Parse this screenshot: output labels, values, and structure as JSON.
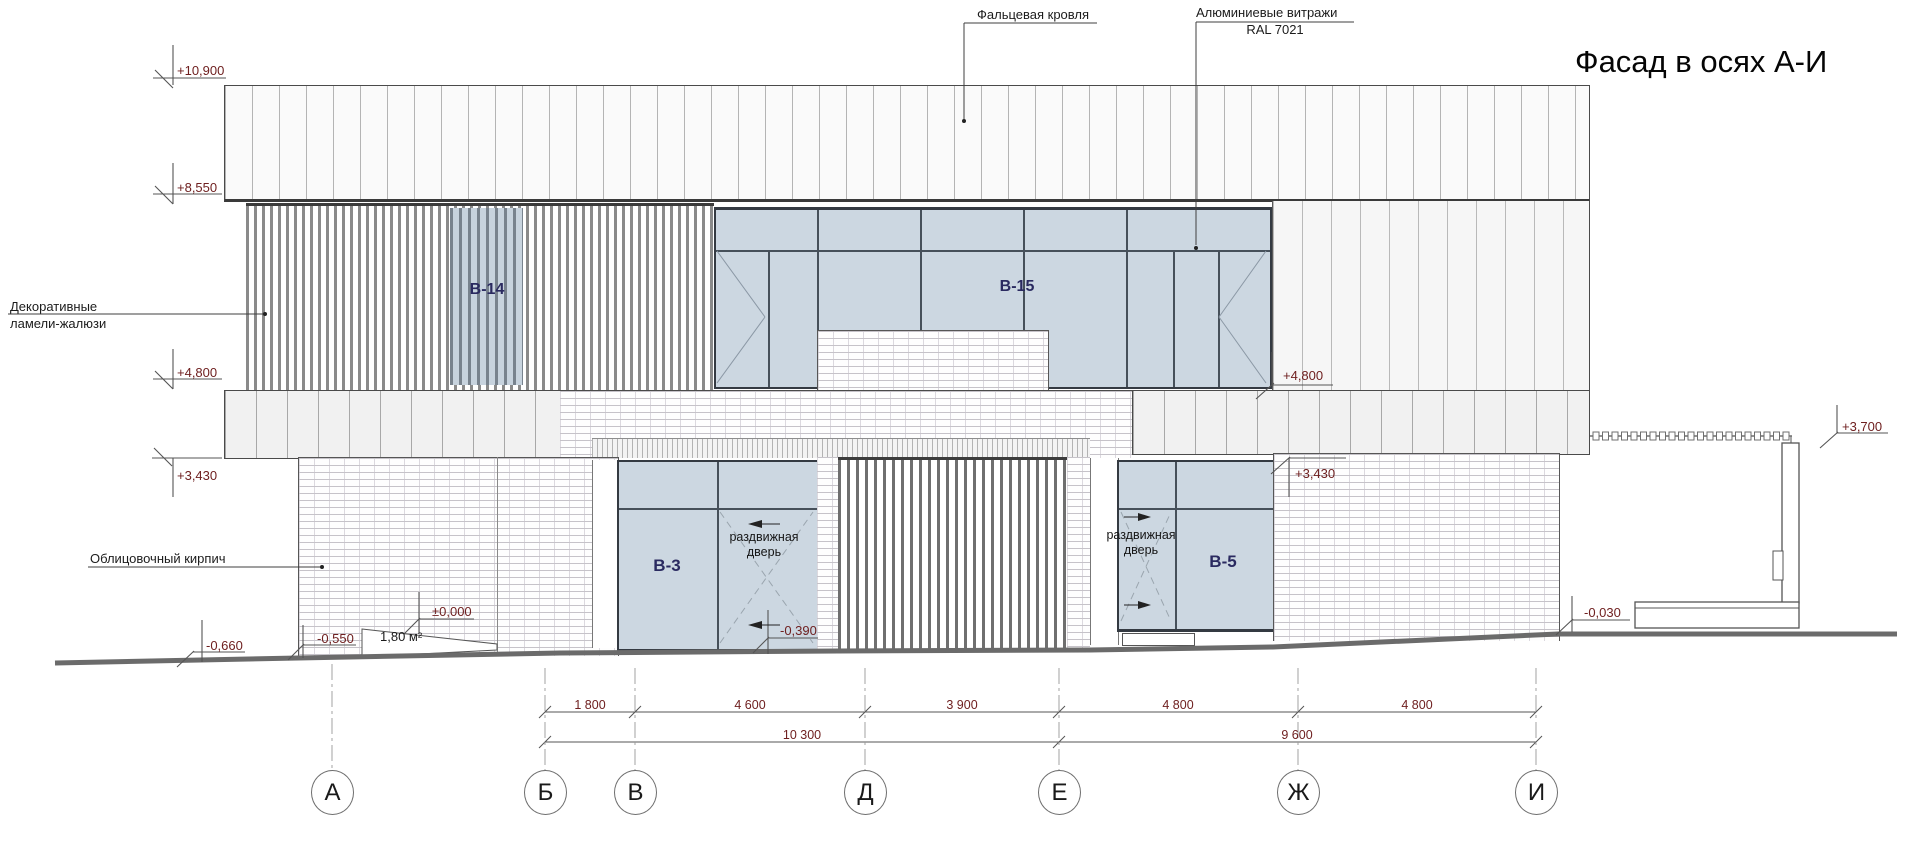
{
  "title": "Фасад в осях А-И",
  "callouts": {
    "roof": "Фальцевая кровля",
    "glazing": {
      "line1": "Алюминиевые витражи",
      "line2": "RAL 7021"
    },
    "louvers": {
      "line1": "Декоративные",
      "line2": "ламели-жалюзи"
    },
    "brick": "Облицовочный кирпич",
    "sliding_door": {
      "line1": "раздвижная",
      "line2": "дверь"
    }
  },
  "window_tags": {
    "b14": "В-14",
    "b15": "В-15",
    "b3": "В-3",
    "b5": "В-5"
  },
  "levels": {
    "p10900": "+10,900",
    "p8550": "+8,550",
    "p4800_left": "+4,800",
    "p3430_left": "+3,430",
    "p4800_right": "+4,800",
    "p3430_right": "+3,430",
    "p3700": "+3,700",
    "m0030": "-0,030",
    "m0660": "-0,660",
    "m0550": "-0,550",
    "zero": "±0,000",
    "m0390": "-0,390"
  },
  "area_note": "1,80 м²",
  "dimensions": {
    "row1": [
      "1 800",
      "4 600",
      "3 900",
      "4 800",
      "4 800"
    ],
    "row2": [
      "10 300",
      "9 600"
    ]
  },
  "axes": [
    "А",
    "Б",
    "В",
    "Д",
    "Е",
    "Ж",
    "И"
  ]
}
